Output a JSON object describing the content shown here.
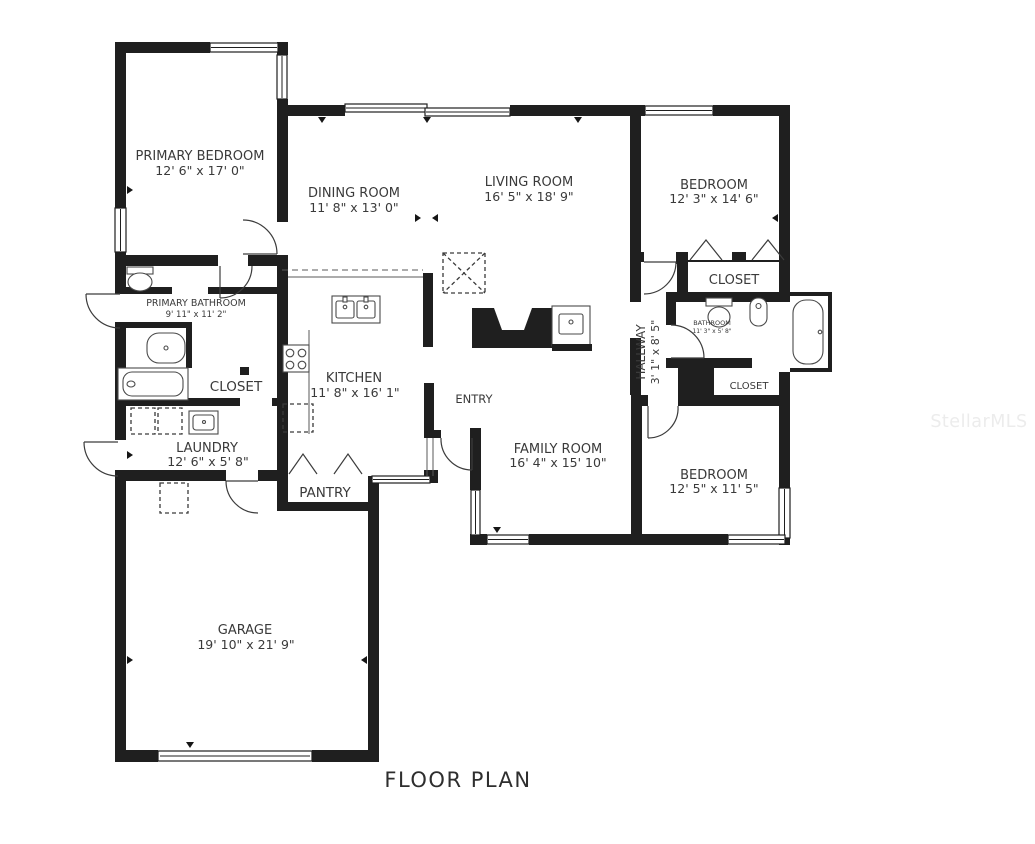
{
  "title": "FLOOR PLAN",
  "watermark": "StellarMLS",
  "colors": {
    "wall": "#1f1f1f",
    "text": "#3a3a3a",
    "watermark": "#ececec"
  },
  "rooms": {
    "primary_bedroom": {
      "name": "PRIMARY BEDROOM",
      "dims": "12' 6\" x 17' 0\""
    },
    "dining_room": {
      "name": "DINING ROOM",
      "dims": "11' 8\" x 13' 0\""
    },
    "living_room": {
      "name": "LIVING ROOM",
      "dims": "16' 5\" x 18' 9\""
    },
    "bedroom_top_right": {
      "name": "BEDROOM",
      "dims": "12' 3\" x 14' 6\""
    },
    "closet_top_right": {
      "name": "CLOSET"
    },
    "primary_bathroom": {
      "name": "PRIMARY BATHROOM",
      "dims": "9' 11\" x 11' 2\""
    },
    "primary_closet": {
      "name": "CLOSET"
    },
    "hallway": {
      "name": "HALLWAY",
      "dims": "3' 1\" x 8' 5\""
    },
    "bathroom": {
      "name": "BATHROOM",
      "dims": "11' 3\" x 5' 8\""
    },
    "hall_closet": {
      "name": "CLOSET"
    },
    "kitchen": {
      "name": "KITCHEN",
      "dims": "11' 8\" x 16' 1\""
    },
    "laundry": {
      "name": "LAUNDRY",
      "dims": "12' 6\" x 5' 8\""
    },
    "pantry": {
      "name": "PANTRY"
    },
    "entry": {
      "name": "ENTRY"
    },
    "family_room": {
      "name": "FAMILY ROOM",
      "dims": "16' 4\" x 15' 10\""
    },
    "bedroom_bottom_right": {
      "name": "BEDROOM",
      "dims": "12' 5\" x 11' 5\""
    },
    "garage": {
      "name": "GARAGE",
      "dims": "19' 10\" x 21' 9\""
    }
  }
}
